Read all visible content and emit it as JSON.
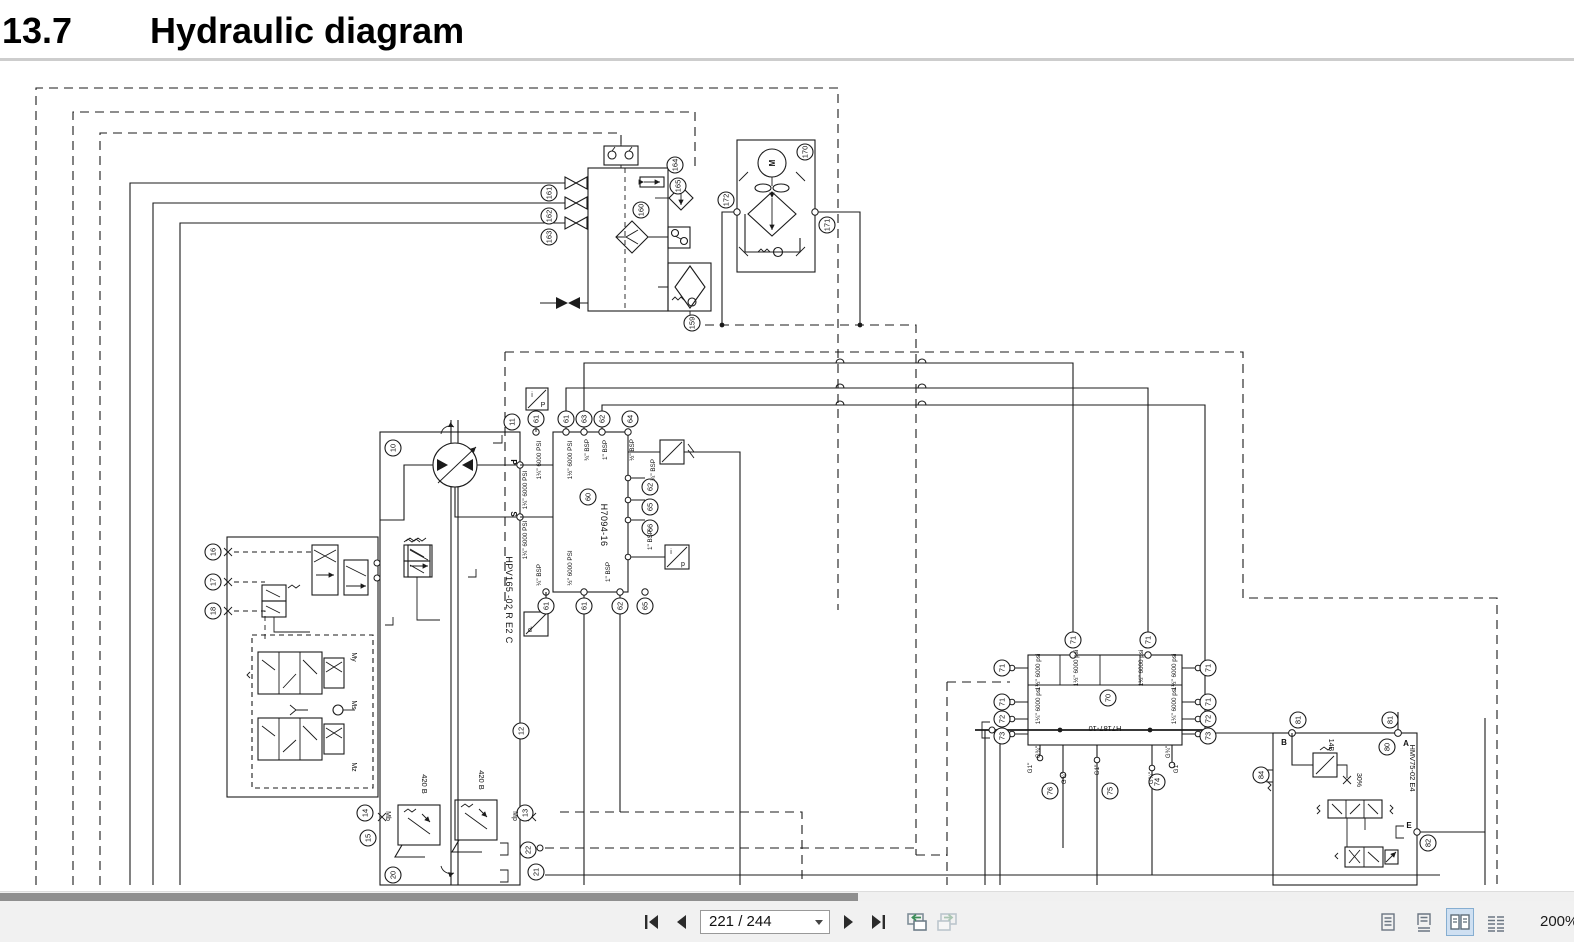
{
  "page": {
    "section_number": "13.7",
    "title": "Hydraulic diagram"
  },
  "toolbar": {
    "page_indicator": "221 / 244",
    "zoom_level": "200%"
  },
  "diagram": {
    "component_labels": {
      "pump": "HPV165 -02 R E2 C",
      "center_manifold": "H7094-16",
      "right_manifold": "H7187-10",
      "motor_valve_block": "HMV75-02 E4",
      "relief_left": "420 B",
      "relief_right": "420 B",
      "orifice_percent": "30%",
      "pilot_valve": "14B",
      "motor": "M"
    },
    "port_letters": [
      "P",
      "S",
      "B",
      "A",
      "E",
      "Mb",
      "Mp",
      "My",
      "Ms",
      "Mz"
    ],
    "sensor_letters": [
      "i",
      "P",
      "i",
      "p",
      "d"
    ],
    "refs": [
      "161",
      "162",
      "163",
      "164",
      "165",
      "160",
      "159",
      "170",
      "172",
      "171",
      "10",
      "11",
      "61",
      "61",
      "63",
      "62",
      "64",
      "60",
      "62",
      "65",
      "66",
      "61",
      "61",
      "62",
      "65",
      "16",
      "17",
      "18",
      "12",
      "14",
      "15",
      "13",
      "22",
      "21",
      "20",
      "71",
      "71",
      "71",
      "71",
      "71",
      "71",
      "70",
      "72",
      "72",
      "73",
      "73",
      "76",
      "75",
      "74",
      "81",
      "81",
      "80",
      "84",
      "82"
    ],
    "port_sizes": [
      "1¼\" 6000 PSI",
      "1½\" 6000 PSI",
      "¾\" BSP",
      "1\" BSP",
      "½\" BSP",
      "1¼\" 6000 PSI",
      "1¼\" 6000 PSI",
      "¼\" BSP",
      "½\" 6000 PSI",
      "1\" BSP",
      "¾\" BSP",
      "1\" BSP",
      "1½\" 6000 psi",
      "1½\" 6000 psi",
      "1½\" 6000 psi",
      "1½\" 6000 psi",
      "1¼\" 6000 psi",
      "1¼\" 6000 psi",
      "G¾\"",
      "G¾\"",
      "G1\"",
      "G¾\"",
      "G1\"",
      "G¾\"",
      "G1\""
    ]
  }
}
